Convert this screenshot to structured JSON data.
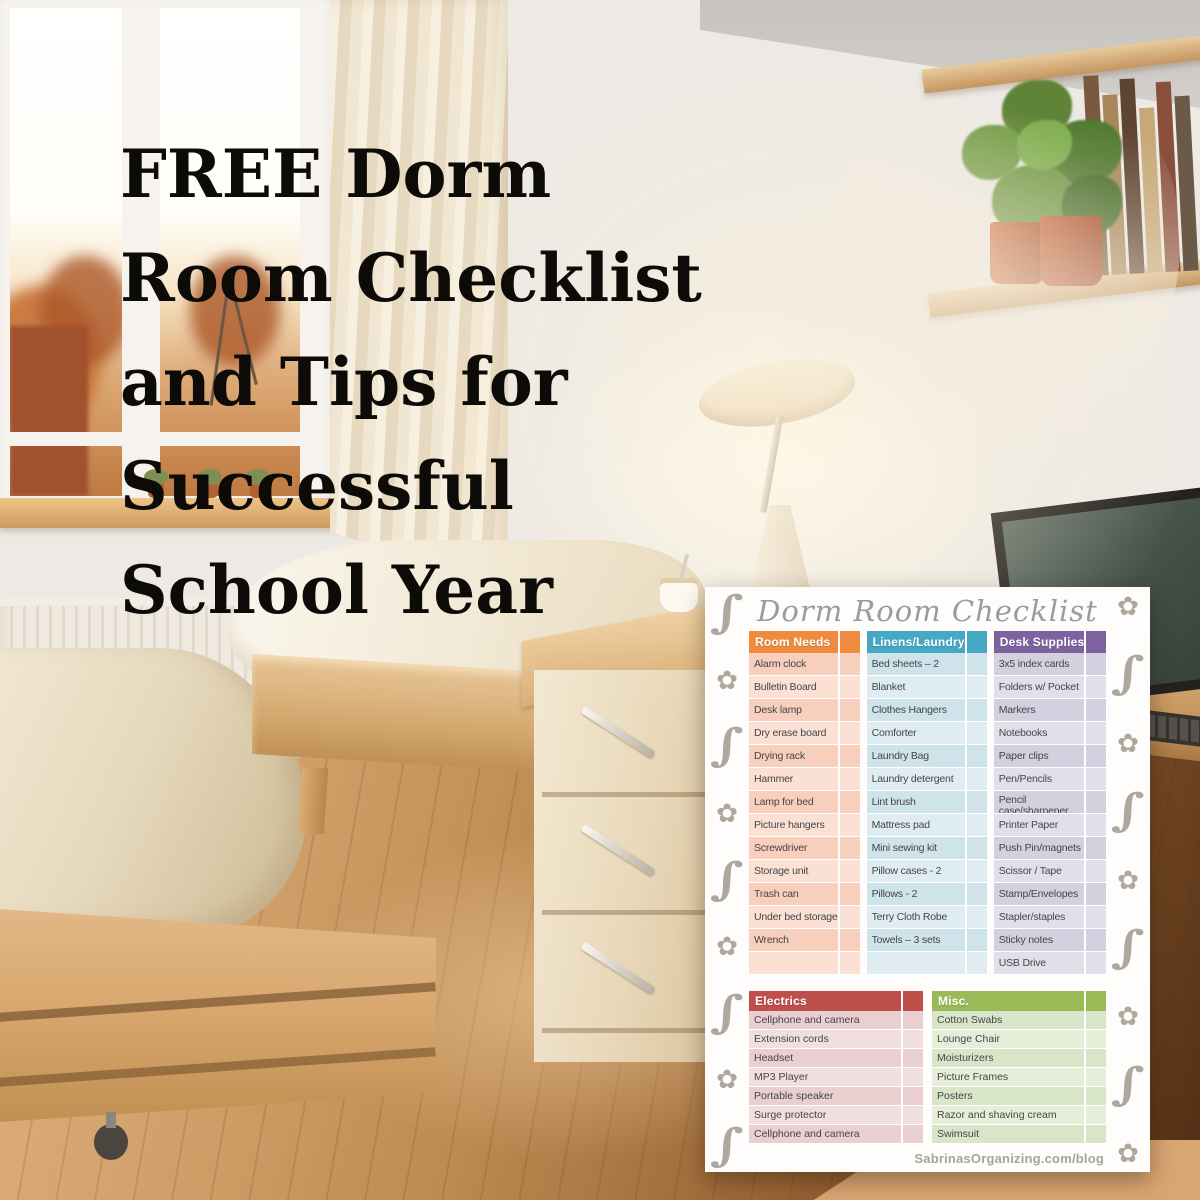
{
  "headline": {
    "lines": [
      "FREE Dorm",
      "Room Checklist",
      "and Tips for",
      "Successful",
      "School Year"
    ],
    "color": "#0d0b08"
  },
  "card": {
    "title": "Dorm Room Checklist",
    "title_color": "#9b9b99",
    "footer": "SabrinasOrganizing.com/blog",
    "footer_color": "#a6a49e",
    "flourish_color": "#aca89e",
    "border_icons": {
      "swirl": "∫",
      "flower": "✿"
    },
    "sections": [
      {
        "id": "room-needs",
        "label": "Room Needs",
        "placement": "top",
        "header_color": "#EE8B3F",
        "row_colors": [
          "#F7CFBC",
          "#FAE1D4"
        ],
        "items": [
          "Alarm clock",
          "Bulletin Board",
          "Desk lamp",
          "Dry erase board",
          "Drying rack",
          "Hammer",
          "Lamp for bed",
          "Picture hangers",
          "Screwdriver",
          "Storage unit",
          "Trash can",
          "Under bed storage",
          "Wrench"
        ]
      },
      {
        "id": "linens-laundry",
        "label": "Linens/Laundry",
        "placement": "top",
        "header_color": "#45A8C4",
        "row_colors": [
          "#CFE3EB",
          "#DFEDF2"
        ],
        "items": [
          "Bed sheets – 2",
          "Blanket",
          "Clothes Hangers",
          "Comforter",
          "Laundry Bag",
          "Laundry detergent",
          "Lint brush",
          "Mattress pad",
          "Mini sewing kit",
          "Pillow cases - 2",
          "Pillows - 2",
          "Terry Cloth Robe",
          "Towels – 3 sets"
        ]
      },
      {
        "id": "desk-supplies",
        "label": "Desk Supplies",
        "placement": "top",
        "header_color": "#7C63A0",
        "row_colors": [
          "#D4D0E0",
          "#E2DFEA"
        ],
        "items": [
          "3x5 index cards",
          "Folders w/ Pocket",
          "Markers",
          "Notebooks",
          "Paper clips",
          "Pen/Pencils",
          "Pencil case/sharpener",
          "Printer Paper",
          "Push Pin/magnets",
          "Scissor / Tape",
          "Stamp/Envelopes",
          "Stapler/staples",
          "Sticky notes",
          "USB Drive"
        ]
      },
      {
        "id": "electrics",
        "label": "Electrics",
        "placement": "bottom",
        "header_color": "#BF4F4B",
        "row_colors": [
          "#EACFD1",
          "#F1DFE0"
        ],
        "items": [
          "Cellphone and camera",
          "Extension cords",
          "Headset",
          "MP3 Player",
          "Portable speaker",
          "Surge protector",
          "Cellphone and camera"
        ]
      },
      {
        "id": "misc",
        "label": "Misc.",
        "placement": "bottom",
        "header_color": "#9ABA57",
        "row_colors": [
          "#D9E5C8",
          "#E6EEDA"
        ],
        "items": [
          "Cotton Swabs",
          "Lounge Chair",
          "Moisturizers",
          "Picture Frames",
          "Posters",
          "Razor and shaving cream",
          "Swimsuit"
        ]
      }
    ]
  }
}
